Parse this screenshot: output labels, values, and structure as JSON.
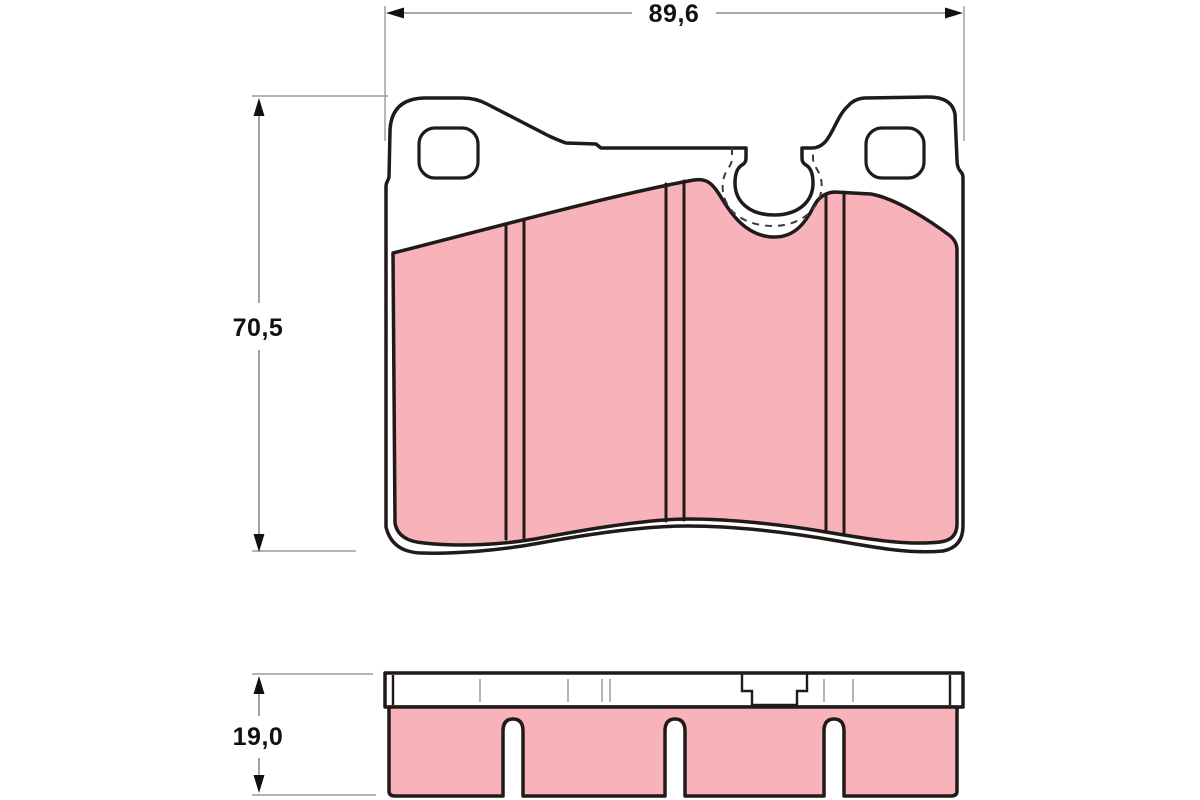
{
  "drawing": {
    "type": "brake-pad-technical-drawing",
    "views": {
      "front_view": "pad front profile with mounting ears, two mounting holes, keyhole sensor notch and three vertical grooves",
      "side_view": "pad thickness profile with backing plate, center tab and three bottom slots"
    },
    "dimension_labels": {
      "width": "89,6",
      "height": "70,5",
      "thickness": "19,0"
    }
  },
  "colors": {
    "friction_material": "#f8b2ba",
    "backing_plate": "#ffffff",
    "outline": "#201a18",
    "dimension_line": "#8c8c8c",
    "dimension_text": "#111111",
    "background": "#ffffff"
  }
}
